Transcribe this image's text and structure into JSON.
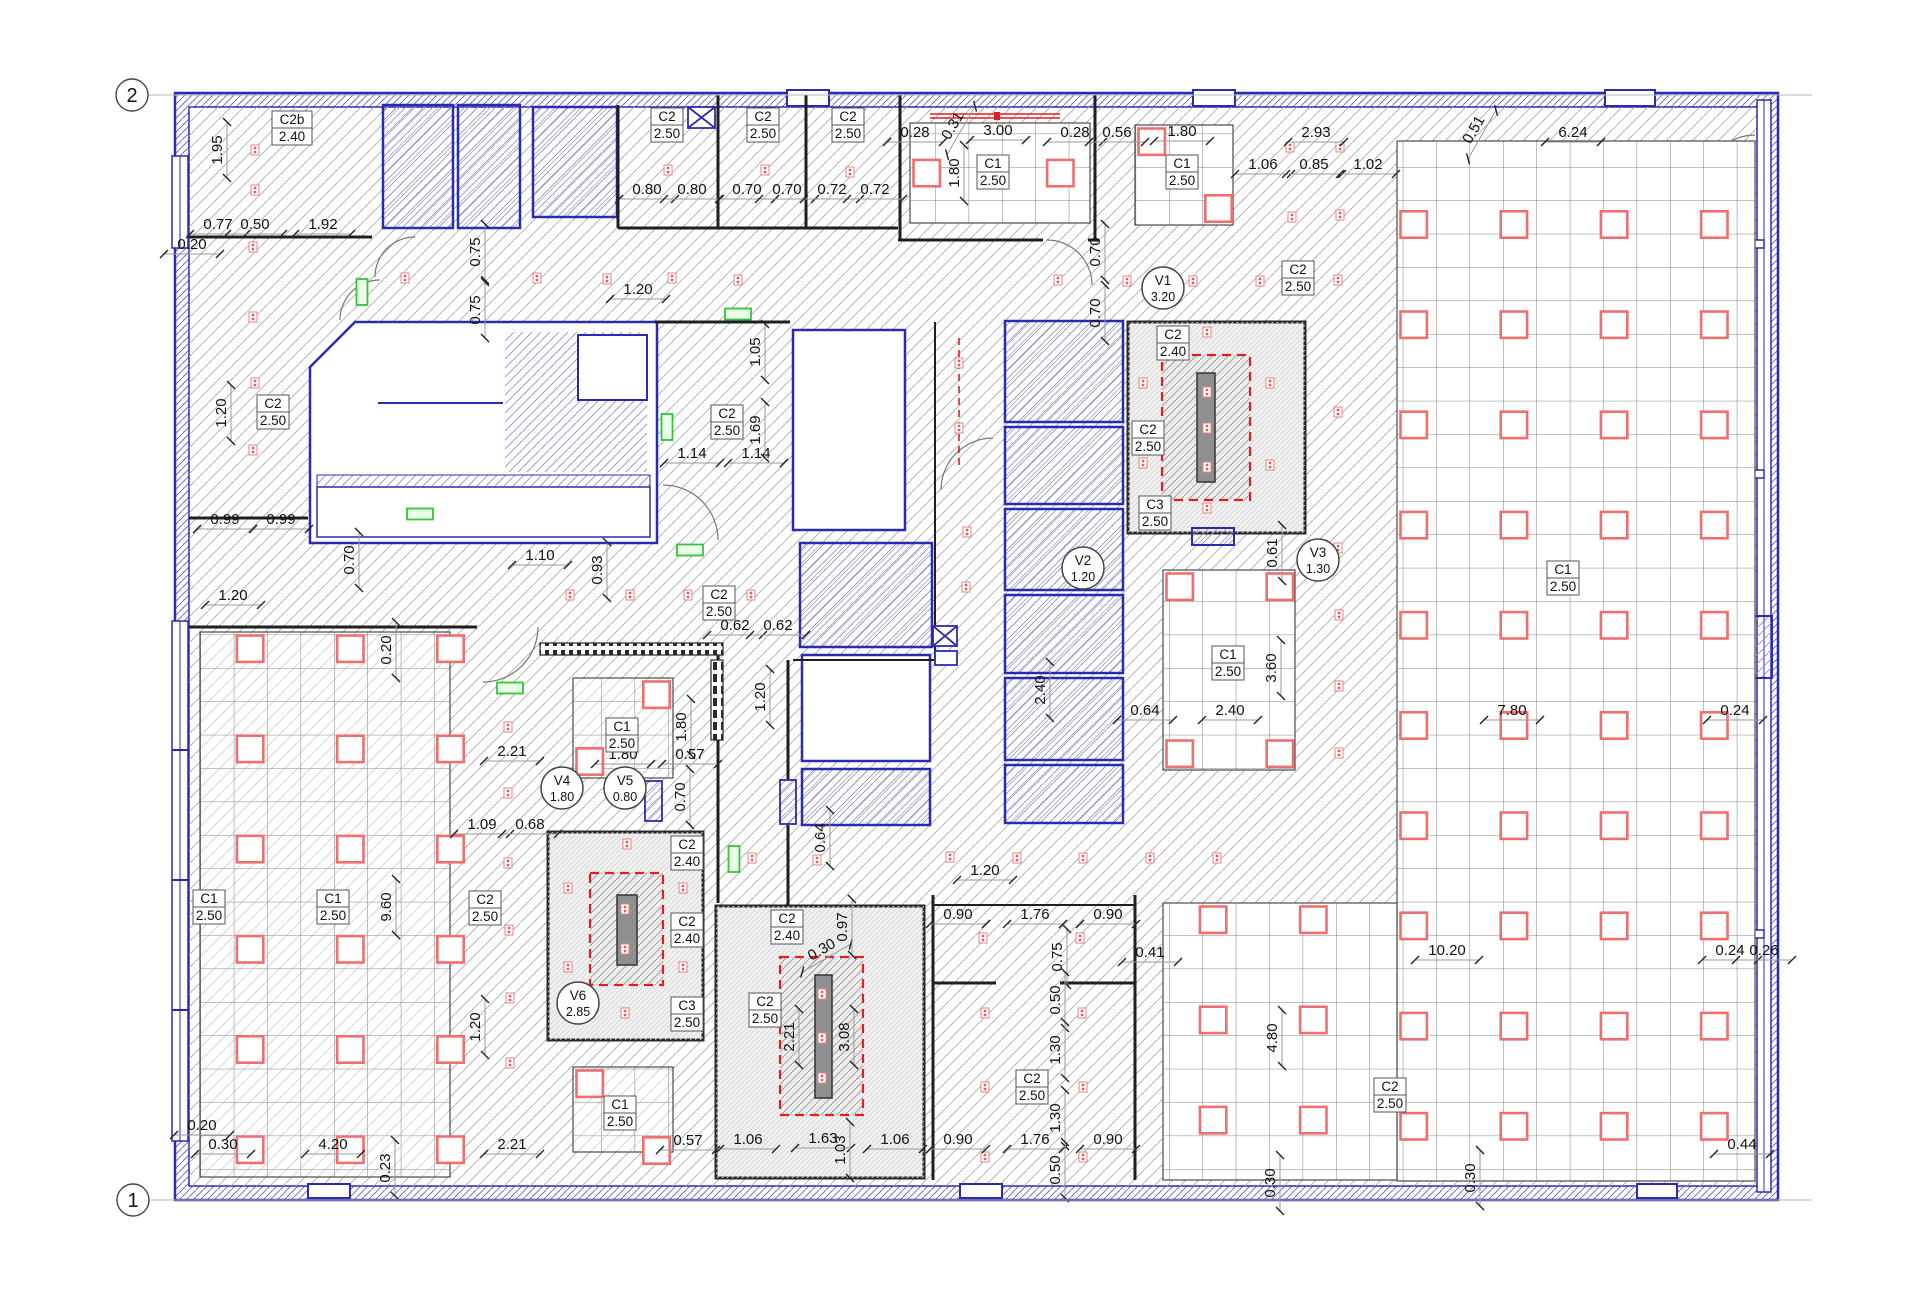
{
  "colors": {
    "wall_blue": "#2b2bb0",
    "hatch_blue": "#8585e0",
    "hatch_gray": "#a8a8a8",
    "wall_black": "#1f1f1f",
    "fixture_red": "#ef6f6f",
    "duct_red": "#e02020",
    "bar_gray": "#8f8f8f",
    "exit_green": "#35c435",
    "shaft_fill": "#f1f1f1"
  },
  "grid_markers": [
    {
      "label": "2",
      "x": 132,
      "y": 95
    },
    {
      "label": "1",
      "x": 133,
      "y": 1200
    }
  ],
  "ceiling_labels": [
    {
      "code": "C2b",
      "height": "2.40",
      "x": 292,
      "y": 128
    },
    {
      "code": "C2",
      "height": "2.50",
      "x": 667,
      "y": 125
    },
    {
      "code": "C2",
      "height": "2.50",
      "x": 763,
      "y": 125
    },
    {
      "code": "C2",
      "height": "2.50",
      "x": 848,
      "y": 125
    },
    {
      "code": "C1",
      "height": "2.50",
      "x": 993,
      "y": 172
    },
    {
      "code": "C1",
      "height": "2.50",
      "x": 1182,
      "y": 172
    },
    {
      "code": "C2",
      "height": "2.50",
      "x": 1298,
      "y": 278
    },
    {
      "code": "C2",
      "height": "2.40",
      "x": 1173,
      "y": 343
    },
    {
      "code": "C2",
      "height": "2.50",
      "x": 1148,
      "y": 438
    },
    {
      "code": "C3",
      "height": "2.50",
      "x": 1155,
      "y": 513
    },
    {
      "code": "C2",
      "height": "2.50",
      "x": 273,
      "y": 412
    },
    {
      "code": "C2",
      "height": "2.50",
      "x": 727,
      "y": 422
    },
    {
      "code": "C2",
      "height": "2.50",
      "x": 719,
      "y": 603
    },
    {
      "code": "C1",
      "height": "2.50",
      "x": 1228,
      "y": 663
    },
    {
      "code": "C1",
      "height": "2.50",
      "x": 1563,
      "y": 578
    },
    {
      "code": "C1",
      "height": "2.50",
      "x": 209,
      "y": 907
    },
    {
      "code": "C1",
      "height": "2.50",
      "x": 333,
      "y": 907
    },
    {
      "code": "C2",
      "height": "2.50",
      "x": 485,
      "y": 908
    },
    {
      "code": "C1",
      "height": "2.50",
      "x": 622,
      "y": 735
    },
    {
      "code": "C2",
      "height": "2.40",
      "x": 687,
      "y": 853
    },
    {
      "code": "C2",
      "height": "2.40",
      "x": 687,
      "y": 930
    },
    {
      "code": "C3",
      "height": "2.50",
      "x": 687,
      "y": 1014
    },
    {
      "code": "C2",
      "height": "2.40",
      "x": 787,
      "y": 927
    },
    {
      "code": "C2",
      "height": "2.50",
      "x": 765,
      "y": 1010
    },
    {
      "code": "C2",
      "height": "2.50",
      "x": 1032,
      "y": 1087
    },
    {
      "code": "C2",
      "height": "2.50",
      "x": 1390,
      "y": 1095
    },
    {
      "code": "C1",
      "height": "2.50",
      "x": 620,
      "y": 1113
    }
  ],
  "vent_labels": [
    {
      "code": "V1",
      "value": "3.20",
      "x": 1163,
      "y": 288
    },
    {
      "code": "V2",
      "value": "1.20",
      "x": 1083,
      "y": 568
    },
    {
      "code": "V3",
      "value": "1.30",
      "x": 1318,
      "y": 560
    },
    {
      "code": "V4",
      "value": "1.80",
      "x": 562,
      "y": 788
    },
    {
      "code": "V5",
      "value": "0.80",
      "x": 625,
      "y": 788
    },
    {
      "code": "V6",
      "value": "2.85",
      "x": 578,
      "y": 1003
    }
  ],
  "dimensions": [
    {
      "t": "1.95",
      "x": 220,
      "y": 150,
      "r": 90
    },
    {
      "t": "0.77",
      "x": 218,
      "y": 227,
      "r": 0
    },
    {
      "t": "0.50",
      "x": 255,
      "y": 227,
      "r": 0
    },
    {
      "t": "1.92",
      "x": 323,
      "y": 227,
      "r": 0
    },
    {
      "t": "0.20",
      "x": 192,
      "y": 247,
      "r": 0
    },
    {
      "t": "0.80",
      "x": 647,
      "y": 192,
      "r": 0
    },
    {
      "t": "0.80",
      "x": 692,
      "y": 192,
      "r": 0
    },
    {
      "t": "0.70",
      "x": 747,
      "y": 192,
      "r": 0
    },
    {
      "t": "0.70",
      "x": 787,
      "y": 192,
      "r": 0
    },
    {
      "t": "0.72",
      "x": 832,
      "y": 192,
      "r": 0
    },
    {
      "t": "0.72",
      "x": 875,
      "y": 192,
      "r": 0
    },
    {
      "t": "0.28",
      "x": 915,
      "y": 135,
      "r": 0
    },
    {
      "t": "0.31",
      "x": 955,
      "y": 127,
      "r": -60
    },
    {
      "t": "3.00",
      "x": 998,
      "y": 133,
      "r": 0
    },
    {
      "t": "0.28",
      "x": 1075,
      "y": 135,
      "r": 0
    },
    {
      "t": "1.80",
      "x": 957,
      "y": 173,
      "r": 90
    },
    {
      "t": "0.56",
      "x": 1117,
      "y": 135,
      "r": 0
    },
    {
      "t": "1.80",
      "x": 1182,
      "y": 134,
      "r": 0
    },
    {
      "t": "2.93",
      "x": 1316,
      "y": 135,
      "r": 0
    },
    {
      "t": "1.06",
      "x": 1263,
      "y": 167,
      "r": 0
    },
    {
      "t": "0.85",
      "x": 1314,
      "y": 167,
      "r": 0
    },
    {
      "t": "1.02",
      "x": 1368,
      "y": 167,
      "r": 0
    },
    {
      "t": "0.51",
      "x": 1476,
      "y": 131,
      "r": -60
    },
    {
      "t": "6.24",
      "x": 1573,
      "y": 135,
      "r": 0
    },
    {
      "t": "0.70",
      "x": 1098,
      "y": 252,
      "r": 90
    },
    {
      "t": "0.70",
      "x": 1098,
      "y": 313,
      "r": 90
    },
    {
      "t": "0.75",
      "x": 478,
      "y": 252,
      "r": 90
    },
    {
      "t": "0.75",
      "x": 478,
      "y": 310,
      "r": 90
    },
    {
      "t": "1.20",
      "x": 638,
      "y": 292,
      "r": 0
    },
    {
      "t": "1.20",
      "x": 224,
      "y": 413,
      "r": 90
    },
    {
      "t": "0.99",
      "x": 225,
      "y": 522,
      "r": 0
    },
    {
      "t": "0.99",
      "x": 281,
      "y": 522,
      "r": 0
    },
    {
      "t": "1.20",
      "x": 233,
      "y": 598,
      "r": 0
    },
    {
      "t": "0.70",
      "x": 352,
      "y": 560,
      "r": 90
    },
    {
      "t": "1.10",
      "x": 540,
      "y": 558,
      "r": 0
    },
    {
      "t": "0.93",
      "x": 600,
      "y": 570,
      "r": 90
    },
    {
      "t": "0.20",
      "x": 389,
      "y": 650,
      "r": 90
    },
    {
      "t": "1.14",
      "x": 692,
      "y": 456,
      "r": 0
    },
    {
      "t": "1.14",
      "x": 756,
      "y": 456,
      "r": 0
    },
    {
      "t": "1.69",
      "x": 758,
      "y": 430,
      "r": 90
    },
    {
      "t": "1.05",
      "x": 758,
      "y": 352,
      "r": 90
    },
    {
      "t": "0.62",
      "x": 735,
      "y": 628,
      "r": 0
    },
    {
      "t": "0.62",
      "x": 778,
      "y": 628,
      "r": 0
    },
    {
      "t": "1.20",
      "x": 763,
      "y": 697,
      "r": 90
    },
    {
      "t": "0.64",
      "x": 823,
      "y": 838,
      "r": 90
    },
    {
      "t": "2.40",
      "x": 1043,
      "y": 690,
      "r": 90
    },
    {
      "t": "0.64",
      "x": 1145,
      "y": 713,
      "r": 0
    },
    {
      "t": "2.40",
      "x": 1230,
      "y": 713,
      "r": 0
    },
    {
      "t": "3.60",
      "x": 1274,
      "y": 668,
      "r": 90
    },
    {
      "t": "0.61",
      "x": 1275,
      "y": 553,
      "r": 90
    },
    {
      "t": "7.80",
      "x": 1512,
      "y": 713,
      "r": 0
    },
    {
      "t": "0.24",
      "x": 1735,
      "y": 713,
      "r": 0
    },
    {
      "t": "2.21",
      "x": 512,
      "y": 754,
      "r": 0
    },
    {
      "t": "1.09",
      "x": 482,
      "y": 827,
      "r": 0
    },
    {
      "t": "0.68",
      "x": 530,
      "y": 827,
      "r": 0
    },
    {
      "t": "9.60",
      "x": 389,
      "y": 907,
      "r": 90
    },
    {
      "t": "1.20",
      "x": 478,
      "y": 1027,
      "r": 90
    },
    {
      "t": "0.20",
      "x": 202,
      "y": 1128,
      "r": 0
    },
    {
      "t": "0.30",
      "x": 223,
      "y": 1147,
      "r": 0
    },
    {
      "t": "4.20",
      "x": 333,
      "y": 1147,
      "r": 0
    },
    {
      "t": "0.23",
      "x": 388,
      "y": 1168,
      "r": 90
    },
    {
      "t": "2.21",
      "x": 512,
      "y": 1147,
      "r": 0
    },
    {
      "t": "1.80",
      "x": 623,
      "y": 757,
      "r": 0
    },
    {
      "t": "1.80",
      "x": 684,
      "y": 727,
      "r": 90
    },
    {
      "t": "0.57",
      "x": 690,
      "y": 757,
      "r": 0
    },
    {
      "t": "0.70",
      "x": 683,
      "y": 797,
      "r": 90
    },
    {
      "t": "0.30",
      "x": 823,
      "y": 952,
      "r": -30
    },
    {
      "t": "0.97",
      "x": 845,
      "y": 927,
      "r": 90
    },
    {
      "t": "2.21",
      "x": 792,
      "y": 1037,
      "r": 90
    },
    {
      "t": "3.08",
      "x": 847,
      "y": 1037,
      "r": 90
    },
    {
      "t": "1.06",
      "x": 748,
      "y": 1142,
      "r": 0
    },
    {
      "t": "1.63",
      "x": 823,
      "y": 1141,
      "r": 0
    },
    {
      "t": "1.03",
      "x": 843,
      "y": 1150,
      "r": 90
    },
    {
      "t": "0.57",
      "x": 688,
      "y": 1143,
      "r": 0
    },
    {
      "t": "1.06",
      "x": 895,
      "y": 1142,
      "r": 0
    },
    {
      "t": "1.20",
      "x": 985,
      "y": 873,
      "r": 0
    },
    {
      "t": "0.90",
      "x": 958,
      "y": 917,
      "r": 0
    },
    {
      "t": "1.76",
      "x": 1035,
      "y": 917,
      "r": 0
    },
    {
      "t": "0.90",
      "x": 1108,
      "y": 917,
      "r": 0
    },
    {
      "t": "0.41",
      "x": 1150,
      "y": 955,
      "r": 0
    },
    {
      "t": "0.75",
      "x": 1060,
      "y": 957,
      "r": 90
    },
    {
      "t": "0.50",
      "x": 1058,
      "y": 1000,
      "r": 90
    },
    {
      "t": "1.30",
      "x": 1058,
      "y": 1050,
      "r": 90
    },
    {
      "t": "1.30",
      "x": 1058,
      "y": 1118,
      "r": 90
    },
    {
      "t": "0.90",
      "x": 958,
      "y": 1142,
      "r": 0
    },
    {
      "t": "1.76",
      "x": 1035,
      "y": 1142,
      "r": 0
    },
    {
      "t": "0.90",
      "x": 1108,
      "y": 1142,
      "r": 0
    },
    {
      "t": "0.50",
      "x": 1058,
      "y": 1170,
      "r": 90
    },
    {
      "t": "4.80",
      "x": 1275,
      "y": 1038,
      "r": 90
    },
    {
      "t": "10.20",
      "x": 1447,
      "y": 953,
      "r": 0
    },
    {
      "t": "0.24",
      "x": 1730,
      "y": 953,
      "r": 0
    },
    {
      "t": "0.26",
      "x": 1764,
      "y": 953,
      "r": 0
    },
    {
      "t": "0.30",
      "x": 1473,
      "y": 1178,
      "r": 90
    },
    {
      "t": "0.30",
      "x": 1273,
      "y": 1183,
      "r": 90
    },
    {
      "t": "0.44",
      "x": 1742,
      "y": 1147,
      "r": 0
    }
  ],
  "ceiling_grids": [
    {
      "x": 910,
      "y": 123,
      "w": 180,
      "h": 100,
      "f": [
        [
          0,
          1
        ],
        [
          4,
          1
        ]
      ],
      "hatch": false
    },
    {
      "x": 1135,
      "y": 125,
      "w": 98,
      "h": 100,
      "f": [
        [
          0,
          0
        ],
        [
          2,
          2
        ]
      ],
      "hatch": false
    },
    {
      "x": 1397,
      "y": 141,
      "w": 358,
      "h": 1040,
      "fx_cols": [
        0,
        3,
        6,
        9
      ],
      "fx_rows": [
        2,
        5,
        8,
        11,
        14,
        17,
        20,
        23,
        26,
        29
      ],
      "hatch": false
    },
    {
      "x": 1163,
      "y": 903,
      "w": 234,
      "h": 277,
      "fx_cols": [
        1,
        4
      ],
      "fx_rows": [
        0,
        3,
        6
      ],
      "hatch": false
    },
    {
      "x": 1163,
      "y": 570,
      "w": 132,
      "h": 200,
      "f": [
        [
          0,
          0
        ],
        [
          3,
          0
        ],
        [
          0,
          5
        ],
        [
          3,
          5
        ]
      ],
      "hatch": false
    },
    {
      "x": 200,
      "y": 632,
      "w": 250,
      "h": 545,
      "fx_cols": [
        1,
        4,
        7
      ],
      "fx_rows": [
        0,
        3,
        6,
        9,
        12,
        15
      ],
      "hatch": true
    },
    {
      "x": 573,
      "y": 678,
      "w": 100,
      "h": 100,
      "f": [
        [
          2,
          0
        ],
        [
          0,
          2
        ]
      ],
      "hatch": true
    },
    {
      "x": 573,
      "y": 1067,
      "w": 100,
      "h": 85,
      "f": [
        [
          0,
          0
        ],
        [
          2,
          2
        ]
      ],
      "hatch": true
    }
  ],
  "sprinklers": [
    [
      255,
      150
    ],
    [
      255,
      190
    ],
    [
      253,
      247
    ],
    [
      668,
      170
    ],
    [
      765,
      170
    ],
    [
      850,
      172
    ],
    [
      1290,
      147
    ],
    [
      1340,
      147
    ],
    [
      1292,
      217
    ],
    [
      1340,
      215
    ],
    [
      405,
      278
    ],
    [
      537,
      278
    ],
    [
      607,
      279
    ],
    [
      672,
      278
    ],
    [
      738,
      280
    ],
    [
      1058,
      280
    ],
    [
      1127,
      281
    ],
    [
      1193,
      281
    ],
    [
      1260,
      281
    ],
    [
      1338,
      280
    ],
    [
      253,
      317
    ],
    [
      255,
      383
    ],
    [
      253,
      450
    ],
    [
      570,
      595
    ],
    [
      630,
      595
    ],
    [
      688,
      595
    ],
    [
      751,
      595
    ],
    [
      959,
      363
    ],
    [
      959,
      428
    ],
    [
      967,
      532
    ],
    [
      966,
      587
    ],
    [
      1143,
      383
    ],
    [
      1270,
      383
    ],
    [
      1338,
      412
    ],
    [
      1143,
      463
    ],
    [
      1270,
      465
    ],
    [
      1207,
      332
    ],
    [
      1207,
      508
    ],
    [
      1338,
      548
    ],
    [
      1207,
      392
    ],
    [
      1207,
      428
    ],
    [
      1207,
      467
    ],
    [
      1339,
      615
    ],
    [
      1339,
      686
    ],
    [
      1339,
      753
    ],
    [
      508,
      727
    ],
    [
      508,
      793
    ],
    [
      508,
      863
    ],
    [
      509,
      930
    ],
    [
      627,
      844
    ],
    [
      568,
      888
    ],
    [
      568,
      967
    ],
    [
      510,
      998
    ],
    [
      510,
      1063
    ],
    [
      625,
      1013
    ],
    [
      683,
      888
    ],
    [
      683,
      967
    ],
    [
      625,
      909
    ],
    [
      625,
      949
    ],
    [
      752,
      858
    ],
    [
      817,
      860
    ],
    [
      822,
      994
    ],
    [
      822,
      1038
    ],
    [
      822,
      1078
    ],
    [
      950,
      857
    ],
    [
      1017,
      858
    ],
    [
      1083,
      858
    ],
    [
      1150,
      858
    ],
    [
      1217,
      858
    ],
    [
      983,
      938
    ],
    [
      1080,
      938
    ],
    [
      985,
      1013
    ],
    [
      1082,
      1013
    ],
    [
      985,
      1087
    ],
    [
      1083,
      1087
    ],
    [
      985,
      1157
    ],
    [
      1083,
      1157
    ]
  ],
  "exit_lights": [
    {
      "x": 362,
      "y": 292,
      "o": "v"
    },
    {
      "x": 738,
      "y": 314,
      "o": "h"
    },
    {
      "x": 667,
      "y": 427,
      "o": "v"
    },
    {
      "x": 690,
      "y": 550,
      "o": "h"
    },
    {
      "x": 510,
      "y": 688,
      "o": "h"
    },
    {
      "x": 734,
      "y": 859,
      "o": "v"
    },
    {
      "x": 420,
      "y": 514,
      "o": "h"
    }
  ]
}
